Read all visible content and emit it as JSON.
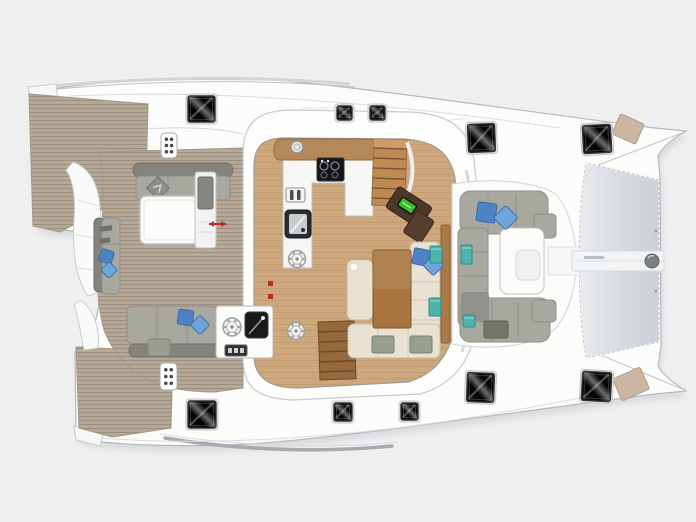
{
  "meta": {
    "subject": "catamaran-deck-floor-plan",
    "orientation": "bow-right",
    "text_visible": false
  },
  "colors": {
    "background": "#efeff0",
    "hull_white": "#fcfcfb",
    "outline": "#b4b9bd",
    "teak": "#b6a897",
    "teak_line": "#60524a",
    "saloon_floor": "#cda87c",
    "counter_white": "#f6f6f4",
    "wood_counter": "#b5885a",
    "stairs_wood": "#c08a55",
    "stairs_wood_dark": "#96693c",
    "table_wood": "#a8743f",
    "nav_desk": "#4c372b",
    "nav_screen": "#3fbe2c",
    "cushion_cream": "#e9e2d2",
    "cushion_gray": "#a8a7a0",
    "cushion_gray_dark": "#84837d",
    "pillow_blue": "#4d82c4",
    "pillow_blue_light": "#6ea3dc",
    "pillow_teal": "#4fb3ab",
    "hatch_black": "#0a0a0a",
    "tramp_light": "#e9ebee",
    "tramp_dark": "#ccd1d7",
    "marker_red": "#c0272d",
    "tan_patch": "#cbb6a3"
  },
  "areas": [
    "port-swim-platform",
    "starboard-swim-platform",
    "aft-cockpit",
    "saloon-galley",
    "saloon-dining",
    "nav-station",
    "forward-cockpit",
    "trampoline",
    "side-decks"
  ],
  "hatches": [
    {
      "x": 188,
      "y": 96,
      "w": 27,
      "h": 26,
      "rot": 0
    },
    {
      "x": 337,
      "y": 106,
      "w": 15,
      "h": 14,
      "rot": 0
    },
    {
      "x": 370,
      "y": 106,
      "w": 15,
      "h": 14,
      "rot": 0
    },
    {
      "x": 468,
      "y": 124,
      "w": 27,
      "h": 28,
      "rot": -2
    },
    {
      "x": 583,
      "y": 125,
      "w": 28,
      "h": 28,
      "rot": -3
    },
    {
      "x": 188,
      "y": 401,
      "w": 28,
      "h": 27,
      "rot": 0
    },
    {
      "x": 334,
      "y": 403,
      "w": 18,
      "h": 18,
      "rot": 0
    },
    {
      "x": 401,
      "y": 403,
      "w": 17,
      "h": 17,
      "rot": 0
    },
    {
      "x": 467,
      "y": 373,
      "w": 27,
      "h": 29,
      "rot": 2
    },
    {
      "x": 582,
      "y": 372,
      "w": 29,
      "h": 29,
      "rot": 3
    }
  ],
  "panels_6dot": [
    {
      "x": 161,
      "y": 133,
      "w": 16,
      "h": 25
    },
    {
      "x": 160,
      "y": 363,
      "w": 17,
      "h": 27
    }
  ],
  "round_fixtures": [
    {
      "cx": 297,
      "cy": 147,
      "r": 6,
      "kind": "sink-round"
    },
    {
      "cx": 297,
      "cy": 259,
      "r": 8.5,
      "kind": "vent"
    },
    {
      "cx": 296,
      "cy": 331,
      "r": 8.5,
      "kind": "vent"
    },
    {
      "cx": 232,
      "cy": 327,
      "r": 9,
      "kind": "vent"
    }
  ],
  "pillow_pairs_blue": [
    {
      "x": 100,
      "y": 250,
      "s": 13,
      "rot": 18,
      "dx": 3,
      "dy": 14
    },
    {
      "x": 178,
      "y": 310,
      "s": 15,
      "rot": 8,
      "dx": 15,
      "dy": 8
    },
    {
      "x": 413,
      "y": 249,
      "s": 16,
      "rot": 12,
      "dx": 13,
      "dy": 9
    },
    {
      "x": 477,
      "y": 203,
      "s": 19,
      "rot": 8,
      "dx": 20,
      "dy": 6
    }
  ],
  "pillows_teal": [
    {
      "x": 430,
      "y": 246,
      "w": 12,
      "h": 17
    },
    {
      "x": 429,
      "y": 298,
      "w": 12,
      "h": 18
    },
    {
      "x": 461,
      "y": 245,
      "w": 11,
      "h": 19
    },
    {
      "x": 463,
      "y": 315,
      "w": 12,
      "h": 12
    }
  ],
  "tan_patches": [
    {
      "x": 615,
      "y": 118,
      "w": 26,
      "h": 22,
      "rot": 24
    },
    {
      "x": 616,
      "y": 372,
      "w": 30,
      "h": 24,
      "rot": -24
    }
  ],
  "red_markers": {
    "arrow": {
      "x1": 209,
      "y1": 224,
      "x2": 226,
      "y2": 224
    },
    "dots": [
      {
        "x": 268,
        "y": 281
      },
      {
        "x": 268,
        "y": 294
      }
    ]
  }
}
